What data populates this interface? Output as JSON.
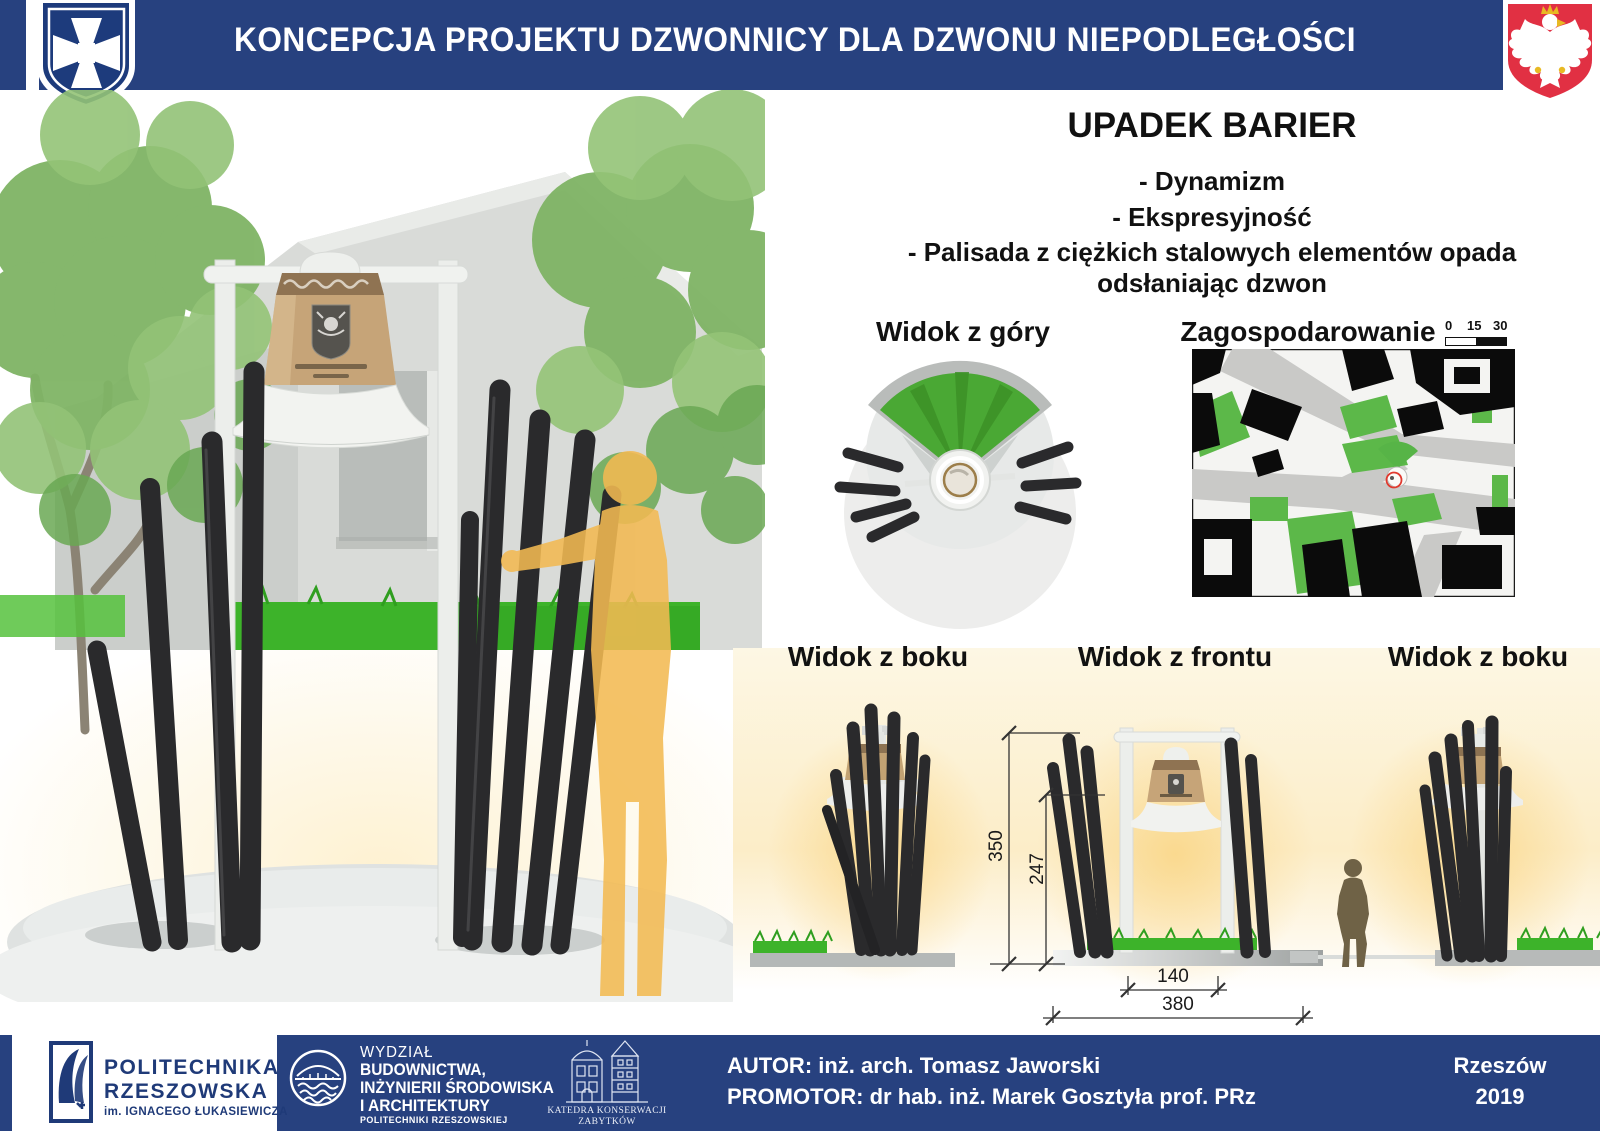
{
  "header": {
    "title": "KONCEPCJA PROJEKTU DZWONNICY DLA DZWONU NIEPODLEGŁOŚCI",
    "icons": {
      "left": "rzeszow-city-crest",
      "right": "poland-eagle-crest"
    }
  },
  "concept": {
    "heading": "UPADEK BARIER",
    "bullets": [
      "- Dynamizm",
      "- Ekspresyjność",
      "- Palisada z ciężkich stalowych elementów opada odsłaniając dzwon"
    ]
  },
  "views": {
    "top_view": "Widok z góry",
    "site_plan": "Zagospodarowanie",
    "scale_ticks": [
      "0",
      "15",
      "30"
    ],
    "side_left": "Widok z boku",
    "front": "Widok z frontu",
    "side_right": "Widok z boku"
  },
  "dimensions": {
    "total_height": "350",
    "inner_height": "247",
    "inner_width": "140",
    "total_width": "380"
  },
  "footer": {
    "university": {
      "line1": "POLITECHNIKA",
      "line2": "RZESZOWSKA",
      "line3": "im. IGNACEGO ŁUKASIEWICZA"
    },
    "faculty": {
      "line1": "WYDZIAŁ",
      "line2": "BUDOWNICTWA,",
      "line3": "INŻYNIERII ŚRODOWISKA",
      "line4": "I ARCHITEKTURY",
      "line5": "POLITECHNIKI RZESZOWSKIEJ"
    },
    "department": {
      "line1": "KATEDRA KONSERWACJI",
      "line2": "ZABYTKÓW"
    },
    "author": "AUTOR: inż. arch. Tomasz Jaworski",
    "promoter": "PROMOTOR:  dr hab. inż. Marek Gosztyła prof. PRz",
    "city": "Rzeszów",
    "year": "2019"
  },
  "colors": {
    "banner_blue": "#27417F",
    "crest_red": "#E13043",
    "grass_green": "#3DB32A",
    "glow_amber": "#FAD88C",
    "pole_black": "#2A2A2C"
  }
}
